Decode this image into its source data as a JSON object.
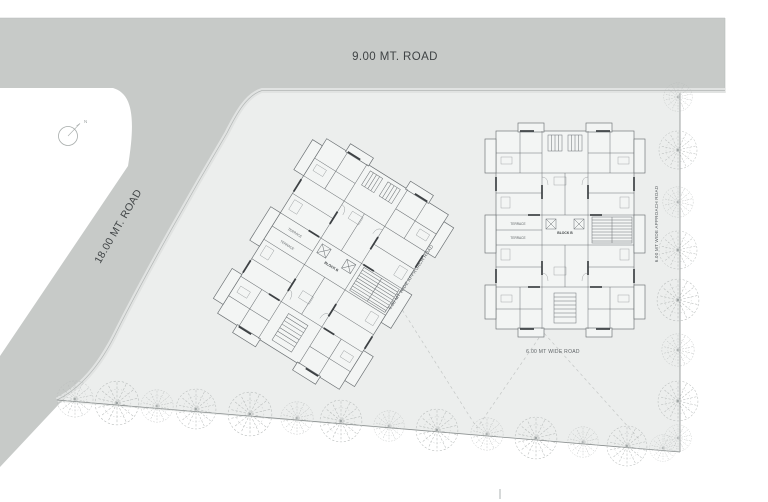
{
  "colors": {
    "road": "#c7cac8",
    "road_edge": "#e1e3e2",
    "edge_line": "#b2b6b5",
    "site": "#eceeed",
    "building_fill": "#f3f5f4",
    "line": "#6a6f72",
    "wall": "#3d4144",
    "tree": "#b7bbba",
    "boundary": "#878c8c",
    "dash": "#c3c6c5",
    "text": "#3f4345",
    "text_secondary": "#5d6265"
  },
  "roads": {
    "top_road_label": "9.00 MT. ROAD",
    "left_road_label": "18.00 MT. ROAD",
    "approach_road_center_label": "6.00 MT WIDE APPROACH ROAD",
    "approach_road_right_label": "6.00 MT WIDE APPROACH ROAD",
    "wide_road_label": "6.00 MT WIDE ROAD"
  },
  "compass": {
    "north_label": "N"
  },
  "buildings": {
    "block_label": "BLOCK B",
    "terrace_label": "TERRACE"
  },
  "site": {
    "trees_bottom": [
      [
        75,
        399,
        19
      ],
      [
        117,
        403,
        23
      ],
      [
        157,
        406,
        17
      ],
      [
        196,
        409,
        21
      ],
      [
        250,
        414,
        23
      ],
      [
        297,
        418,
        17
      ],
      [
        341,
        421,
        22
      ],
      [
        389,
        426,
        16
      ],
      [
        437,
        430,
        22
      ],
      [
        487,
        434,
        17
      ],
      [
        536,
        438,
        22
      ],
      [
        583,
        442,
        16
      ],
      [
        627,
        446,
        21
      ],
      [
        663,
        448,
        14
      ]
    ],
    "trees_right": [
      [
        678,
        97,
        15
      ],
      [
        678,
        150,
        20
      ],
      [
        678,
        202,
        16
      ],
      [
        678,
        250,
        20
      ],
      [
        678,
        300,
        22
      ],
      [
        678,
        350,
        17
      ],
      [
        678,
        401,
        21
      ],
      [
        678,
        438,
        14
      ]
    ]
  }
}
